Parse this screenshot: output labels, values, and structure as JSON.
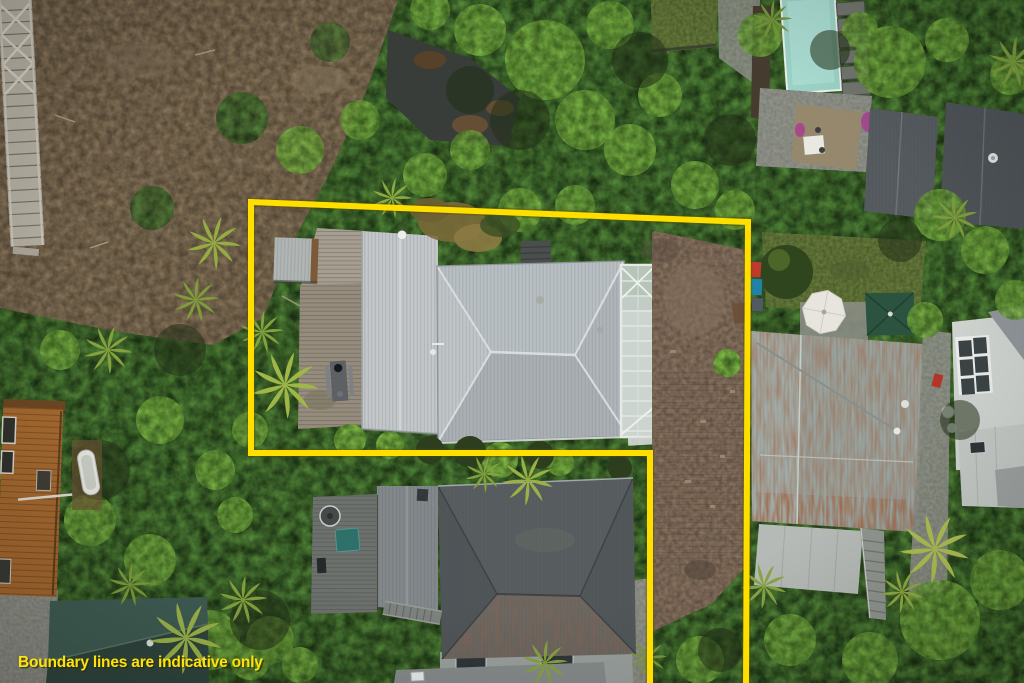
{
  "meta": {
    "width": 1024,
    "height": 683
  },
  "caption": {
    "text": "Boundary lines are indicative only",
    "color": "#FFE20A"
  },
  "boundary": {
    "points": "650,690 650,453 251,453 251,202 748,222 746,690",
    "color": "#FFDF00",
    "width": 6
  },
  "colors": {
    "vegetation_base": "#2D3F1E",
    "pool": "#9AD2C6",
    "main_roof": "#B8BEC2",
    "annex_roof": "#C3C7C9",
    "conservatory": "#CCD4D0",
    "shed_roof": "#B1B6B5",
    "deck": "#958C7D",
    "dark_house_roof": "#585D60",
    "rusty_roof": "#9AA39E",
    "lean_to_roof": "#B5BAB6",
    "teal_roof": "#3F5C53",
    "teal_roof_dark": "#2F463E",
    "orange_building": "#A2672F",
    "umbrella_white": "#E7E5DD",
    "umbrella_green": "#2C5340",
    "white_house": "#CFD3CF",
    "neighbor_roof_a": "#565B5F",
    "neighbor_roof_b": "#4E5357"
  }
}
